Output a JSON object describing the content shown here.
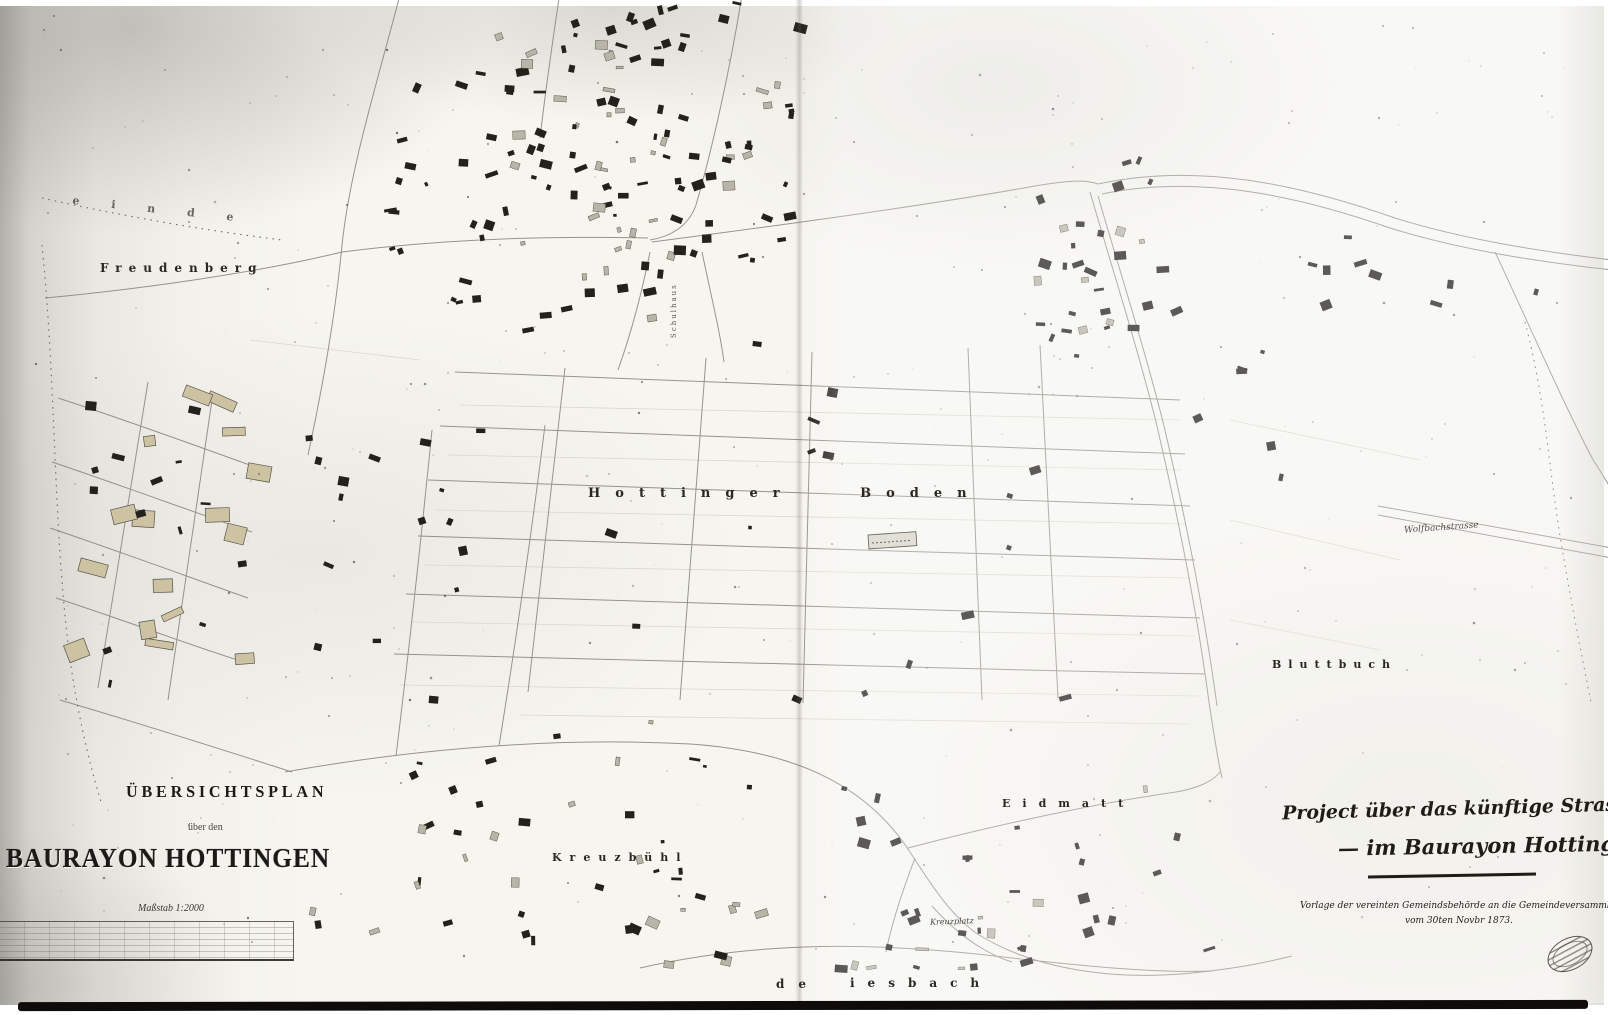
{
  "title_block": {
    "heading": "ÜBERSICHTSPLAN",
    "subheading": "über den",
    "main_title": "BAURAYON HOTTINGEN",
    "scale_label": "Maßstab 1:2000"
  },
  "project_note": {
    "line1": "Project über das künftige Strassennetz",
    "line2": "— im Baurayon Hottingen",
    "line3": "Vorlage der vereinten Gemeindsbehörde an die Gemeindeversammlung",
    "line4": "vom 30ten Novbr 1873."
  },
  "place_labels": {
    "freudenberg": "Freudenberg",
    "hottinger_boden": "Hottinger Boden",
    "kreuzbuehl": "Kreuzbühl",
    "eidmatt": "Eidmatt",
    "bluttbuch": "Bluttbuch",
    "gemeinde_boundary_top": "einde",
    "gemeinde_boundary_bottom_left": "de",
    "gemeinde_boundary_bottom_right": "iesbach",
    "wolfbachstrasse": "Wolfbachstrasse",
    "kreuzplatz": "Kreuzplatz",
    "schulhaus": "Schulhaus"
  },
  "colors": {
    "paper": "#f6f5f0",
    "ink": "#26231e",
    "building_tan": "#cdc3a2",
    "scan_shadow": "#8d8b84"
  }
}
